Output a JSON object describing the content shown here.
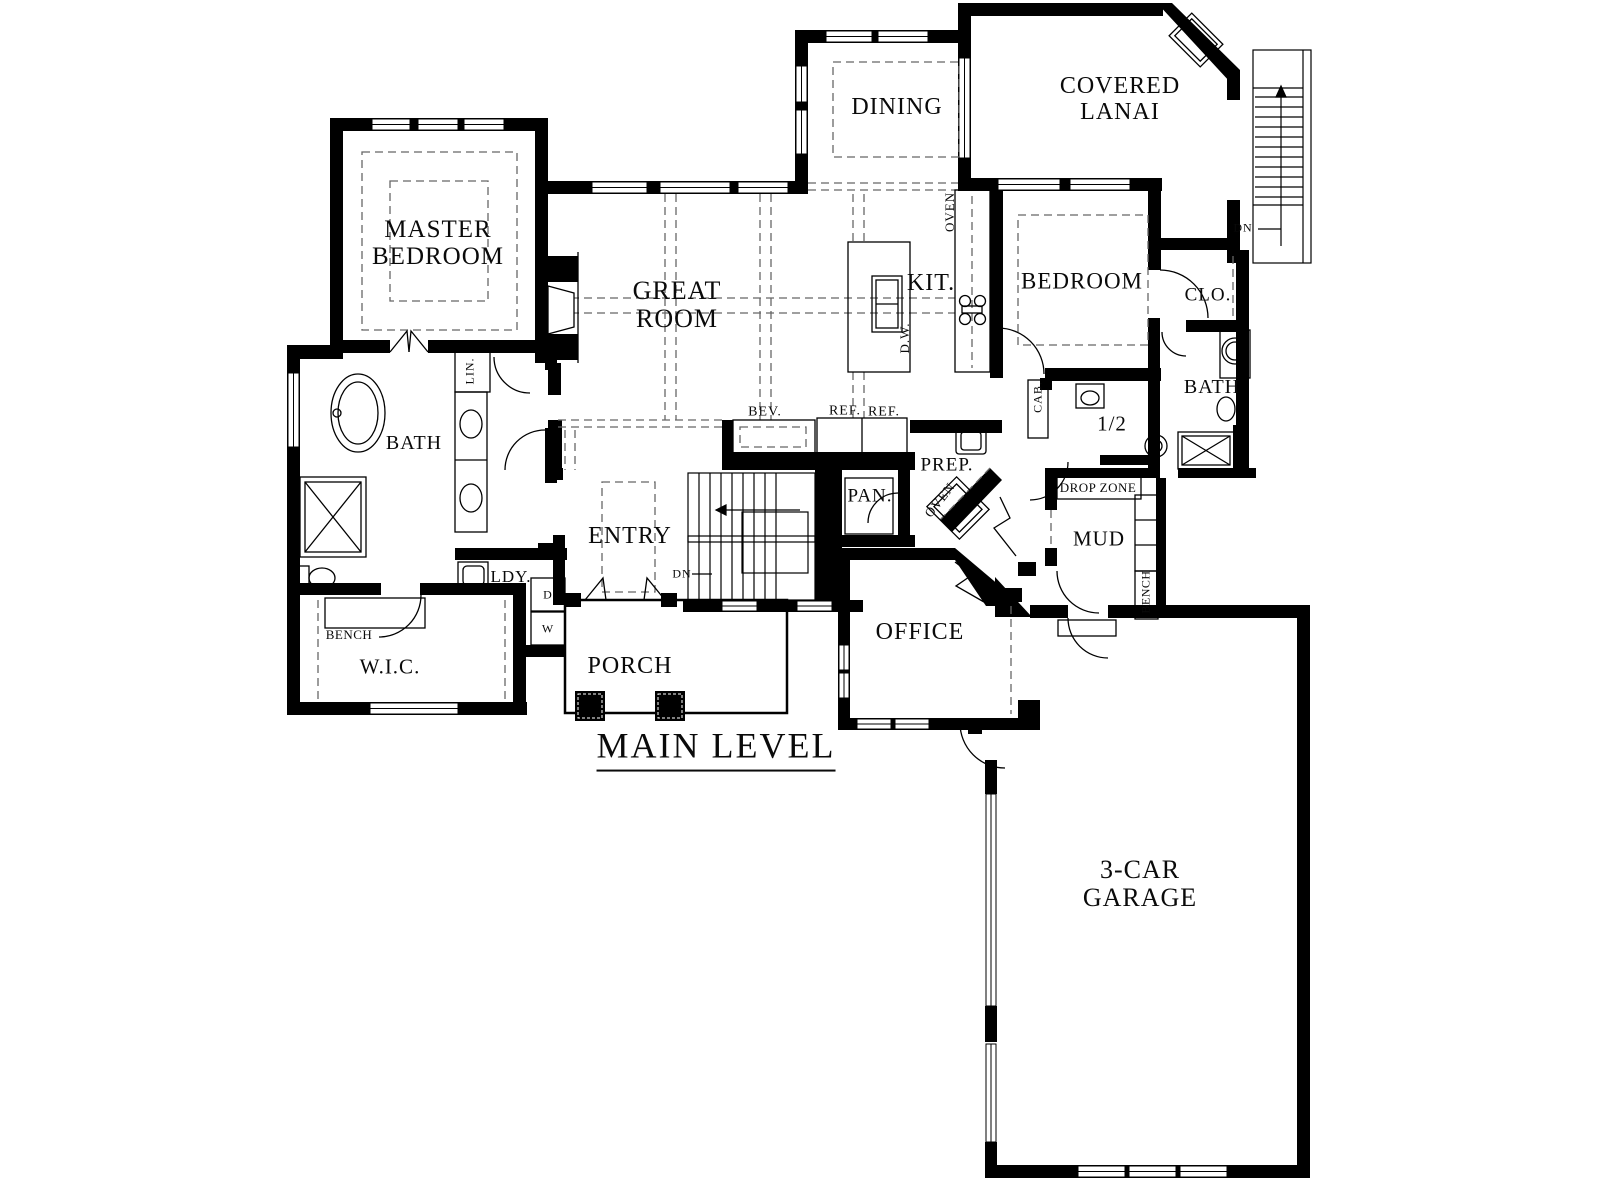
{
  "title": "MAIN LEVEL",
  "colors": {
    "walls": "#000000",
    "background": "#ffffff",
    "dashed_ceiling_lines": "#666666",
    "text": "#0a0a0a"
  },
  "labels": {
    "master_bedroom": "MASTER\nBEDROOM",
    "great_room": "GREAT\nROOM",
    "dining": "DINING",
    "covered_lanai": "COVERED\nLANAI",
    "bedroom": "BEDROOM",
    "clo": "CLO.",
    "bath_right": "BATH",
    "kit": "KIT.",
    "oven_wall": "OVEN",
    "dw": "D.W.",
    "bev": "BEV.",
    "ref1": "REF.",
    "ref2": "REF.",
    "prep": "PREP.",
    "pan": "PAN.",
    "oven_diag": "OVEN",
    "cab": "CAB.",
    "half_bath": "1/2",
    "drop_zone": "DROP ZONE",
    "mud": "MUD",
    "bench_mud": "BENCH",
    "dn_exterior": "DN",
    "bath_left": "BATH",
    "lin": "LIN.",
    "bench_wic": "BENCH",
    "wic": "W.I.C.",
    "ldy": "LDY.",
    "dryer": "D",
    "washer": "W",
    "entry": "ENTRY",
    "dn_entry": "DN",
    "porch": "PORCH",
    "office": "OFFICE",
    "main_level": "MAIN LEVEL",
    "garage": "3-CAR\nGARAGE"
  }
}
